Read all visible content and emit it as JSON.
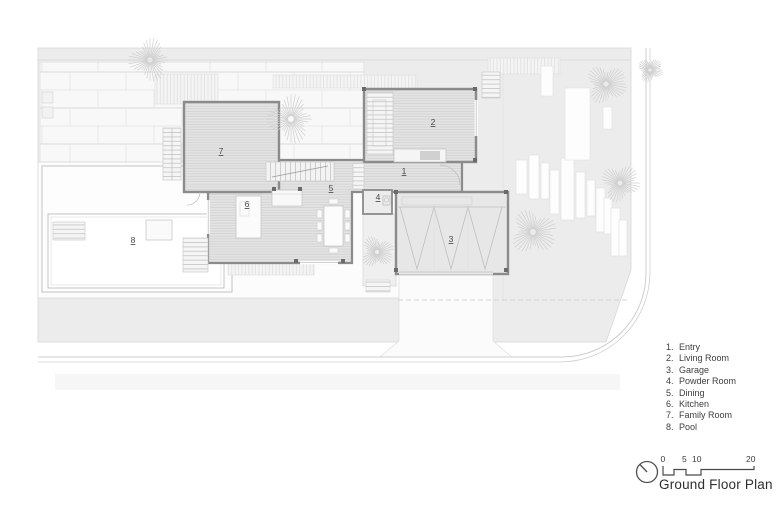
{
  "plan_labels": {
    "entry": "1",
    "living": "2",
    "garage": "3",
    "powder": "4",
    "dining": "5",
    "kitchen": "6",
    "family": "7",
    "pool": "8"
  },
  "legend": {
    "items": [
      {
        "n": "1.",
        "label": "Entry"
      },
      {
        "n": "2.",
        "label": "Living Room"
      },
      {
        "n": "3.",
        "label": "Garage"
      },
      {
        "n": "4.",
        "label": "Powder Room"
      },
      {
        "n": "5.",
        "label": "Dining"
      },
      {
        "n": "6.",
        "label": "Kitchen"
      },
      {
        "n": "7.",
        "label": "Family Room"
      },
      {
        "n": "8.",
        "label": "Pool"
      }
    ]
  },
  "titleblock": {
    "title": "Ground Floor Plan",
    "scale_ticks": {
      "t0": "0",
      "t1": "5",
      "t2": "10",
      "t3": "20"
    }
  },
  "colors": {
    "site": "#ececec",
    "floor": "#e3e3e3",
    "wall": "#8b8b8b",
    "deck": "#f6f6f6",
    "text": "#3c3c3c"
  }
}
